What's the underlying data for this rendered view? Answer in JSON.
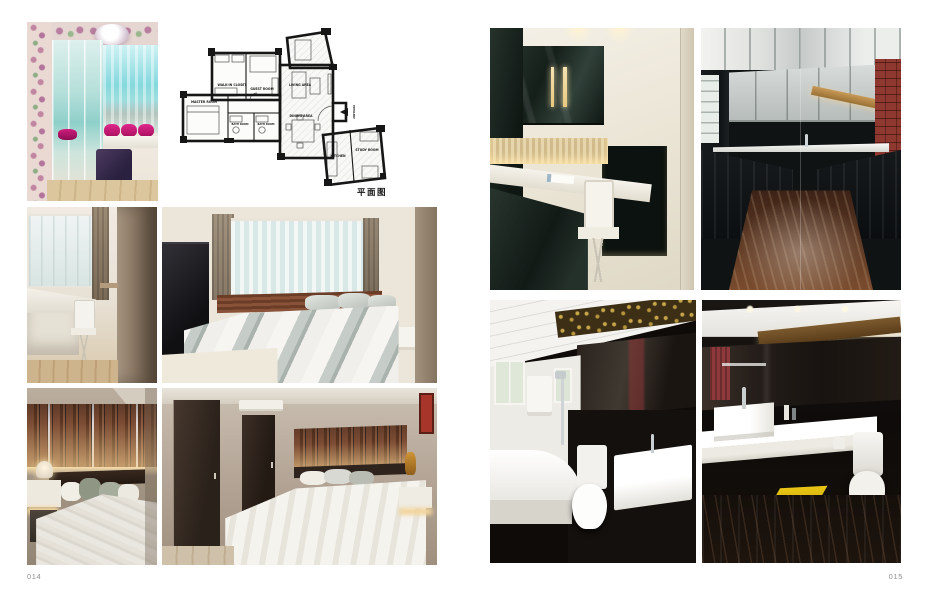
{
  "page": {
    "left_number": "014",
    "right_number": "015"
  },
  "floor_plan": {
    "caption": "平面图",
    "entrance_label": "ENTRANCE",
    "rooms": [
      {
        "label": "WALK-IN CLOSET"
      },
      {
        "label": "GUEST ROOM"
      },
      {
        "label": "MASTER ROOM"
      },
      {
        "label": "BATH ROOM"
      },
      {
        "label": "BATH ROOM"
      },
      {
        "label": "LIVING AREA"
      },
      {
        "label": "DINING AREA"
      },
      {
        "label": "KITCHEN"
      },
      {
        "label": "STUDY ROOM"
      }
    ]
  },
  "photos": [
    {
      "alt": "Dressing corner with floral wallpaper, mirrored wardrobe, bay-window seat with magenta cushions and purple ottoman"
    },
    {
      "alt": "Study desk and white chair beside a curtained window"
    },
    {
      "alt": "Bedroom with timber slat headboard, grey striped bedding and corner window"
    },
    {
      "alt": "Bed with backlit timber slat feature wall, white nightstand and layered pillows"
    },
    {
      "alt": "Bedroom with dark timber doors, air conditioner and white bed"
    },
    {
      "alt": "Home office with dark lacquered cabinets, lit stone splashback, white desk and chair"
    },
    {
      "alt": "Galley kitchen with black gloss units, mirrored ceiling, brick feature wall and marble floor"
    },
    {
      "alt": "Bathroom with white tub, shower set, mirror band, toilet and vessel basin"
    },
    {
      "alt": "Bathroom with floating white vanity, black glossy walls, toilet and yellow mat"
    }
  ],
  "palette": {
    "page_background": "#ffffff",
    "page_number_gray": "#8e8e8e",
    "plan_wall_black": "#161616",
    "magenta_cushion": "#cf1d7d",
    "teal_sky": "#74d4da",
    "timber_brown": "#7c4c34",
    "dark_cabinet_green": "#1c2621",
    "brick_red": "#8f382f",
    "mat_yellow": "#e9c614",
    "warm_backlight": "#f7ddab"
  }
}
